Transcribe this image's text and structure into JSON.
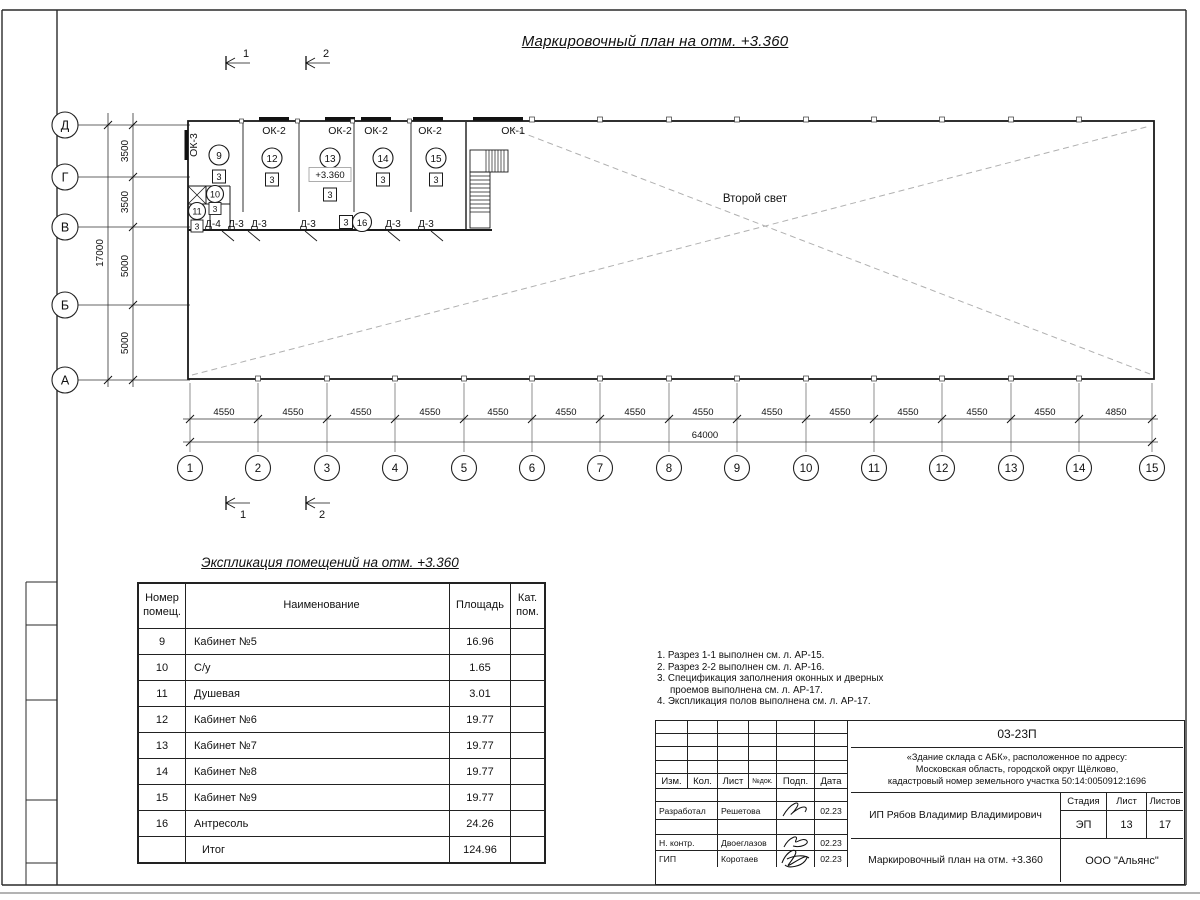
{
  "sheet": {
    "plan_title": "Маркировочный план на отм. +3.360",
    "second_light": "Второй свет"
  },
  "plan": {
    "level_mark": "+3.360",
    "row_axes": [
      "Д",
      "Г",
      "В",
      "Б",
      "А"
    ],
    "row_dims": [
      "3500",
      "3500",
      "5000",
      "5000"
    ],
    "row_total": "17000",
    "col_axes": [
      "1",
      "2",
      "3",
      "4",
      "5",
      "6",
      "7",
      "8",
      "9",
      "10",
      "11",
      "12",
      "13",
      "14",
      "15"
    ],
    "col_dims": [
      "4550",
      "4550",
      "4550",
      "4550",
      "4550",
      "4550",
      "4550",
      "4550",
      "4550",
      "4550",
      "4550",
      "4550",
      "4550",
      "4850"
    ],
    "col_total": "64000",
    "sections": [
      "1",
      "2"
    ],
    "windows": {
      "ok1": "ОК-1",
      "ok2": "ОК-2",
      "ok3": "ОК-3"
    },
    "doors": [
      "Д-4",
      "Д-3",
      "Д-3",
      "Д-3",
      "Д-3",
      "Д-3"
    ],
    "rooms": {
      "r9": {
        "num": "9",
        "cat": "3"
      },
      "r10": {
        "num": "10",
        "cat": "3"
      },
      "r11": {
        "num": "11",
        "cat": "3"
      },
      "r12": {
        "num": "12",
        "cat": "3"
      },
      "r13": {
        "num": "13",
        "cat": "3"
      },
      "r14": {
        "num": "14",
        "cat": "3"
      },
      "r15": {
        "num": "15",
        "cat": "3"
      },
      "r16": {
        "num": "16",
        "cat": "3"
      }
    }
  },
  "explication": {
    "title": "Экспликация помещений на отм. +3.360",
    "headers": {
      "num": "Номер помещ.",
      "name": "Наименование",
      "area": "Площадь",
      "cat": "Кат. пом."
    },
    "rows": [
      {
        "num": "9",
        "name": "Кабинет №5",
        "area": "16.96",
        "cat": ""
      },
      {
        "num": "10",
        "name": "С/у",
        "area": "1.65",
        "cat": ""
      },
      {
        "num": "11",
        "name": "Душевая",
        "area": "3.01",
        "cat": ""
      },
      {
        "num": "12",
        "name": "Кабинет №6",
        "area": "19.77",
        "cat": ""
      },
      {
        "num": "13",
        "name": "Кабинет №7",
        "area": "19.77",
        "cat": ""
      },
      {
        "num": "14",
        "name": "Кабинет №8",
        "area": "19.77",
        "cat": ""
      },
      {
        "num": "15",
        "name": "Кабинет №9",
        "area": "19.77",
        "cat": ""
      },
      {
        "num": "16",
        "name": "Антресоль",
        "area": "24.26",
        "cat": ""
      },
      {
        "num": "",
        "name": "Итог",
        "area": "124.96",
        "cat": ""
      }
    ]
  },
  "notes": [
    "1. Разрез 1-1 выполнен см. л. АР-15.",
    "2. Разрез 2-2 выполнен см. л. АР-16.",
    "3. Спецификация заполнения оконных и дверных",
    "проемов выполнена см. л. АР-17.",
    "4. Экспликация полов выполнена см. л. АР-17."
  ],
  "titleblock": {
    "doc_number": "03-23П",
    "project_line1": "«Здание склада с АБК», расположенное по адресу:",
    "project_line2": "Московская область, городской округ Щёлково,",
    "project_line3": "кадастровый номер земельного участка 50:14:0050912:1696",
    "cols": {
      "izm": "Изм.",
      "kol": "Кол.",
      "list": "Лист",
      "ndok": "№док.",
      "podp": "Подп.",
      "data": "Дата"
    },
    "rows": [
      {
        "role": "Разработал",
        "name": "Решетова",
        "date": "02.23"
      },
      {
        "role": "Н. контр.",
        "name": "Двоеглазов",
        "date": "02.23"
      },
      {
        "role": "ГИП",
        "name": "Коротаев",
        "date": "02.23"
      }
    ],
    "client": "ИП Рябов Владимир Владимирович",
    "stage_header": {
      "stage": "Стадия",
      "sheet": "Лист",
      "sheets": "Листов"
    },
    "stage_values": {
      "stage": "ЭП",
      "sheet": "13",
      "sheets": "17"
    },
    "drawing_name": "Маркировочный план на отм. +3.360",
    "company": "ООО \"Альянс\""
  }
}
